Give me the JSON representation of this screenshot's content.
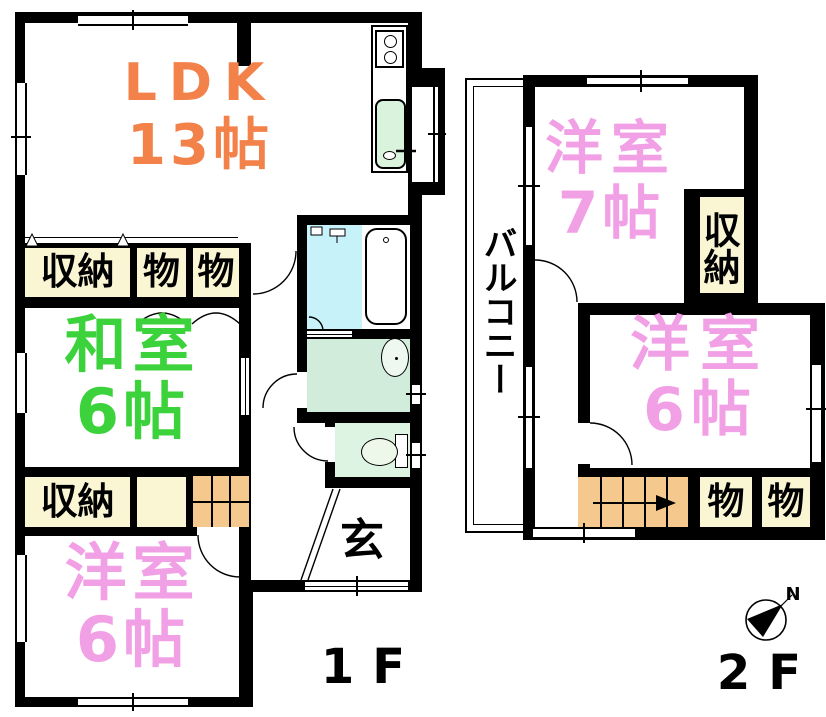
{
  "floor1": {
    "floor_label": "1F",
    "ldk": {
      "name": "LDK",
      "size": "13帖"
    },
    "washitsu": {
      "name": "和室",
      "size": "6帖"
    },
    "youshitsu": {
      "name": "洋室",
      "size": "6帖"
    },
    "closet_top": "収納",
    "mono_top_1": "物",
    "mono_top_2": "物",
    "closet_mid": "収納",
    "genkan": "玄"
  },
  "floor2": {
    "floor_label": "2F",
    "balcony": "バルコニー",
    "room7": {
      "name": "洋室",
      "size": "7帖"
    },
    "room6": {
      "name": "洋室",
      "size": "6帖"
    },
    "closet": "収納",
    "mono_1": "物",
    "mono_2": "物"
  },
  "compass": {
    "north": "N"
  },
  "colors": {
    "wall": "#000000",
    "ldk_text": "#f3824a",
    "washitsu_text": "#3bd23b",
    "youshitsu_text": "#f2a0e6",
    "closet_fill": "#faf5d3",
    "stairs_fill": "#f5c98d",
    "bath_fill": "#c8f2fa",
    "washroom_fill": "#d2ecdc",
    "toilet_fill": "#def4e2",
    "sink_fill": "#d9f3dd"
  }
}
